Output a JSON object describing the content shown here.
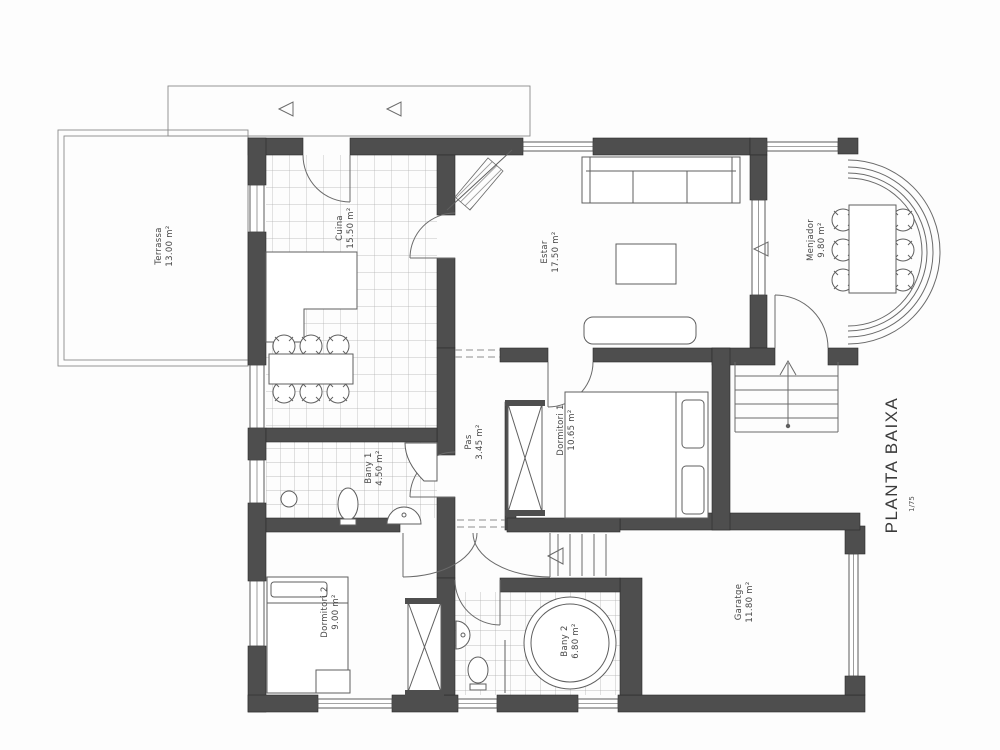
{
  "document": {
    "title": "PLANTA BAIXA",
    "scale": "1/75"
  },
  "rooms": [
    {
      "id": "terrassa",
      "name": "Terrassa",
      "area": "13.00 m²"
    },
    {
      "id": "cuina",
      "name": "Cuina",
      "area": "15.50 m²"
    },
    {
      "id": "estar",
      "name": "Estar",
      "area": "17.50 m²"
    },
    {
      "id": "menjador",
      "name": "Menjador",
      "area": "9.80 m²"
    },
    {
      "id": "dormitori-1",
      "name": "Dormitori 1",
      "area": "10.65 m²"
    },
    {
      "id": "pas",
      "name": "Pas",
      "area": "3.45 m²"
    },
    {
      "id": "bany-1",
      "name": "Bany 1",
      "area": "4.50 m²"
    },
    {
      "id": "dormitori-2",
      "name": "Dormitori 2",
      "area": "9.00 m²"
    },
    {
      "id": "bany-2",
      "name": "Bany 2",
      "area": "6.80 m²"
    },
    {
      "id": "garatge",
      "name": "Garatge",
      "area": "11.80 m²"
    }
  ],
  "colors": {
    "wall": "#4e4e4e",
    "line": "#4a4a4a",
    "tile": "#a8a8a8",
    "paper": "#fdfdfd"
  }
}
